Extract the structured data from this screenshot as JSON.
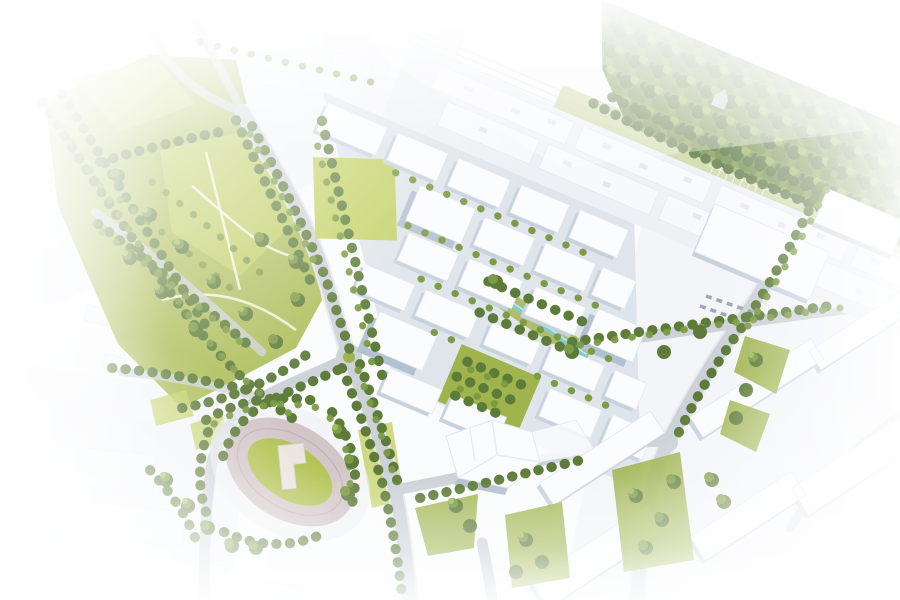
{
  "meta": {
    "title": "Aerial masterplan rendering",
    "type": "architectural-visualization",
    "width_px": 900,
    "height_px": 600
  },
  "scene": {
    "description": "Bird's-eye 3D architectural rendering of an urban redevelopment masterplan: rows of new white apartment blocks with green courtyards between a landscaped park and a diagonal railway yard, a dense forest in the upper right, an oval athletics stadium at the lower left, tree-lined streets, a roundabout, a small canal and major road junctions, all fading to white at the edges.",
    "regions": [
      {
        "id": "forest",
        "label": "Forest (upper right)"
      },
      {
        "id": "railway-yard",
        "label": "Railway yard and industrial halls"
      },
      {
        "id": "new-district",
        "label": "New development blocks with courtyards"
      },
      {
        "id": "park",
        "label": "Public park with lawns and trees"
      },
      {
        "id": "old-town",
        "label": "Existing low-rise neighbourhood (left)"
      },
      {
        "id": "stadium",
        "label": "Oval athletics stadium"
      },
      {
        "id": "canal",
        "label": "Water channel through the district"
      },
      {
        "id": "boulevard",
        "label": "Boulevard and junctions (lower right)"
      },
      {
        "id": "roundabout",
        "label": "Roundabout on the main street"
      }
    ]
  },
  "palette": {
    "background": "#ffffff",
    "white": "#ffffff",
    "haze": "#e9eff5",
    "ground_wash": "#eff2f6",
    "washed_block": "#f4f7fa",
    "road": "#cdd2d9",
    "road_edge": "#e5e9ed",
    "district_base": "#dce2e9",
    "railway_band": "#edf0f4",
    "slab_top": "#f7f9fc",
    "roof_unit": "#e2e8ef",
    "building_top": "#fbfcfe",
    "building_side": "#c8d2dd",
    "building_side_dark": "#b4c1d0",
    "lawn": "#aaba52",
    "lawn_bright": "#c3d266",
    "lawn_mid": "#9fb44c",
    "lawn_pale": "#c7d194",
    "tree_dark": "#5e7c39",
    "tree_mid": "#7c9b45",
    "tree_light": "#a3bd5c",
    "forest_base": "#7d9949",
    "forest_dark": "#52703a",
    "forest_mid": "#6a8942",
    "forest_light": "#95b055",
    "track": "#d3c6c8",
    "track_line": "#c2b2b6",
    "infield": "#b2c353",
    "stadium_building": "#eae5e0",
    "canal": "#82cad4",
    "canal_light": "#c8ebef",
    "car": "#9ca7b4",
    "path_white": "#f6f8f2"
  }
}
